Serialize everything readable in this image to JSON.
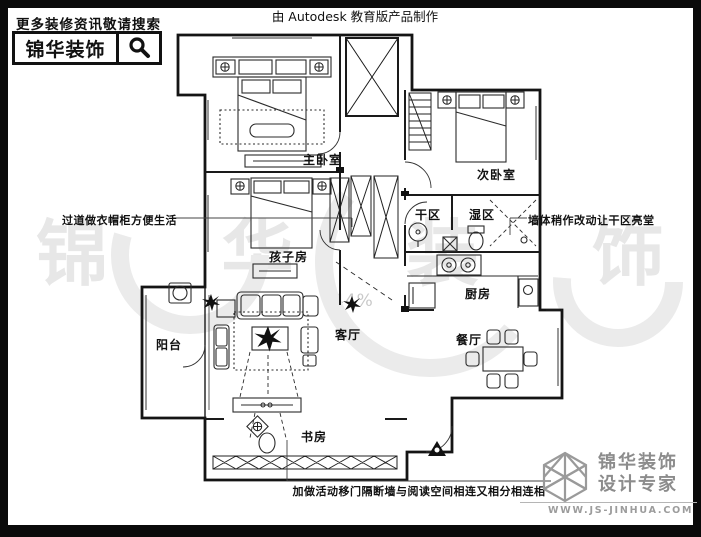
{
  "header": {
    "tagline": "更多装修资讯敬请搜索",
    "brand": "锦华装饰",
    "autodesk_credit": "由 Autodesk 教育版产品制作"
  },
  "watermark": {
    "chars": [
      "锦",
      "华",
      "装",
      "饰"
    ],
    "percent_label": "44%"
  },
  "floorplan": {
    "rooms": [
      {
        "id": "master-bedroom",
        "label": "主卧室"
      },
      {
        "id": "second-bedroom",
        "label": "次卧室"
      },
      {
        "id": "kids-room",
        "label": "孩子房"
      },
      {
        "id": "dry-area",
        "label": "干区"
      },
      {
        "id": "wet-area",
        "label": "湿区"
      },
      {
        "id": "kitchen",
        "label": "厨房"
      },
      {
        "id": "dining-room",
        "label": "餐厅"
      },
      {
        "id": "living-room",
        "label": "客厅"
      },
      {
        "id": "balcony",
        "label": "阳台"
      },
      {
        "id": "study",
        "label": "书房"
      }
    ],
    "annotations": {
      "left": "过道做衣帽柜方便生活",
      "right": "墙体稍作改动让干区亮堂",
      "bottom": "加做活动移门隔断墙与阅读空间相连又相分相连相"
    }
  },
  "footer": {
    "brand": "锦华装饰",
    "subtitle": "设计专家",
    "website": "WWW.JS-JINHUA.COM"
  }
}
